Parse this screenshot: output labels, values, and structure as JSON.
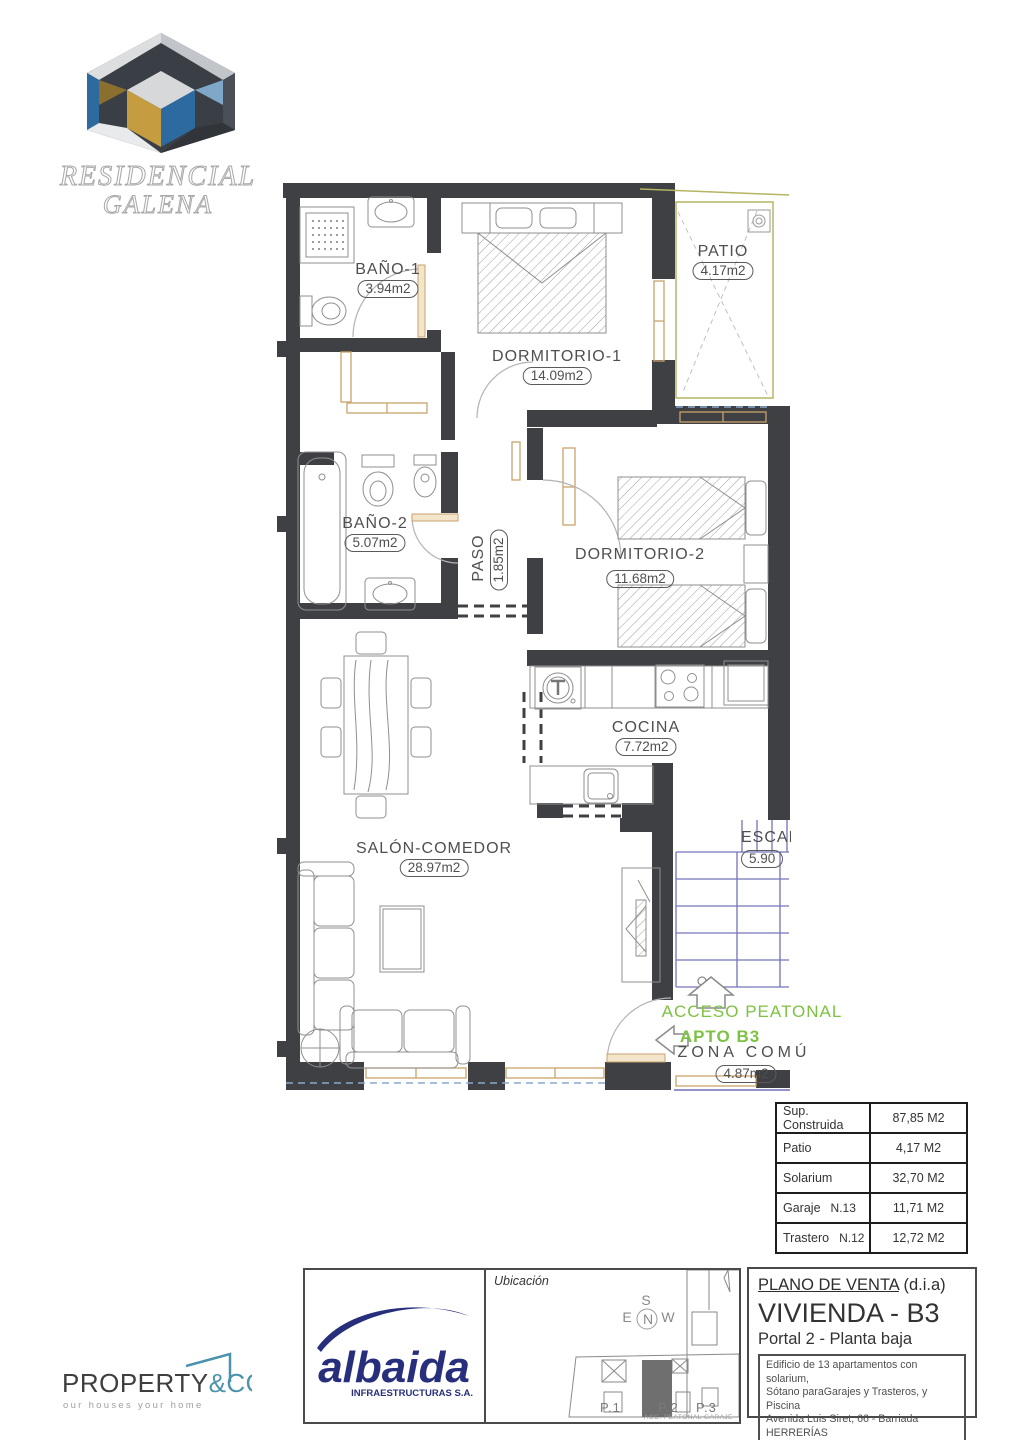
{
  "logo": {
    "line1": "RESIDENCIAL",
    "line2": "GALENA"
  },
  "plan": {
    "rooms": {
      "bano1": {
        "name": "BAÑO-1",
        "area": "3.94m2"
      },
      "dormitorio1": {
        "name": "DORMITORIO-1",
        "area": "14.09m2"
      },
      "patio": {
        "name": "PATIO",
        "area": "4.17m2"
      },
      "bano2": {
        "name": "BAÑO-2",
        "area": "5.07m2"
      },
      "paso": {
        "name": "PASO",
        "area": "1.85m2"
      },
      "dormitorio2": {
        "name": "DORMITORIO-2",
        "area": "11.68m2"
      },
      "cocina": {
        "name": "COCINA",
        "area": "7.72m2"
      },
      "salon": {
        "name": "SALÓN-COMEDOR",
        "area": "28.97m2"
      },
      "escalera": {
        "name": "ESCAL",
        "area": "5.90"
      },
      "zona_comun": {
        "name": "ZONA COMÚ",
        "area": "4.87m2"
      }
    },
    "annotations": {
      "acceso": "ACCESO PEATONAL",
      "apto": "APTO B3"
    }
  },
  "areas_table": {
    "rows": [
      {
        "label": "Sup. Construida",
        "note": "",
        "value": "87,85 M2"
      },
      {
        "label": "Patio",
        "note": "",
        "value": "4,17 M2"
      },
      {
        "label": "Solarium",
        "note": "",
        "value": "32,70 M2"
      },
      {
        "label": "Garaje",
        "note": "N.13",
        "value": "11,71 M2"
      },
      {
        "label": "Trastero",
        "note": "N.12",
        "value": "12,72 M2"
      }
    ]
  },
  "title_block": {
    "plan_type": "PLANO DE VENTA",
    "plan_type_suffix": "(d.i.a)",
    "unit": "VIVIENDA - B3",
    "portal": "Portal 2 - Planta baja",
    "description_lines": [
      "Edificio de 13 apartamentos con solarium,",
      "Sótano paraGarajes y Trasteros, y Piscina",
      "Avenida Luis Siret, 66 - Barriada HERRERÍAS",
      "T.M. CUEVAS DE ALMANZORA (Almeria)"
    ],
    "ubicacion_label": "Ubicación",
    "site_map": {
      "portals": [
        "P.1",
        "P.2",
        "P.3"
      ],
      "caption": "ACC. PEATONAL GARAJE",
      "compass": {
        "n": "N",
        "s": "S",
        "e": "E",
        "w": "W"
      }
    }
  },
  "brands": {
    "albaida": {
      "name": "albaida",
      "subtitle": "INFRAESTRUCTURAS S.A."
    },
    "property": {
      "name": "PROPERTY",
      "suffix": "&CO",
      "tagline": "our houses your home"
    }
  },
  "colors": {
    "wall": "#3e4043",
    "tan": "#c9a36b",
    "olive": "#b5b561",
    "stairs_blue": "#7474ba",
    "green": "#7dc242",
    "albaida_navy": "#272f7d",
    "property_teal": "#4a93ad"
  }
}
